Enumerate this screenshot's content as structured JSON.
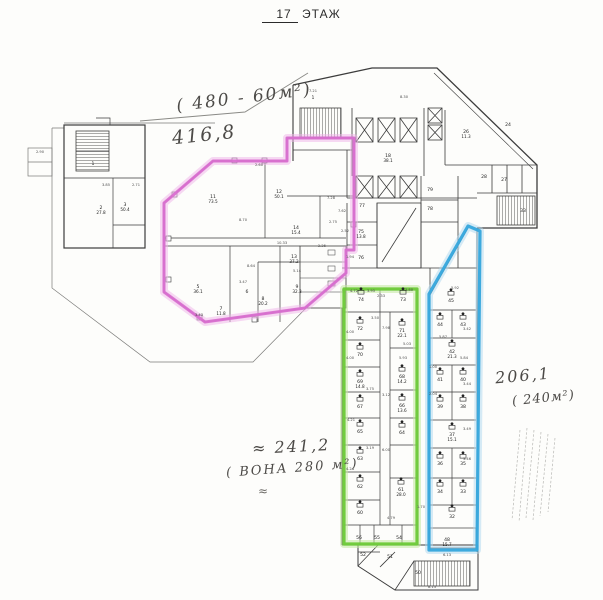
{
  "title": {
    "floor_number": "17",
    "floor_word": "ЭТАЖ"
  },
  "annotations": {
    "top_area_range": "( 480 - 60м²)",
    "top_area_value": "416,8",
    "mid_area_value": "≈ 241,2",
    "mid_area_note": "( ВОНА  280 м²)",
    "mid_squiggle": "≈",
    "right_area_value": "206,1",
    "right_area_note": "( 240м²)"
  },
  "highlights": {
    "pink": {
      "color": "#d96fd0",
      "halo": "#f0b4ea"
    },
    "green": {
      "color": "#6cc938",
      "halo": "#c2e8a0"
    },
    "blue": {
      "color": "#35a6dc",
      "halo": "#aed8f0"
    }
  },
  "rooms": [
    {
      "n": "1",
      "x": 93,
      "y": 165
    },
    {
      "n": "2",
      "a": "27.8",
      "x": 101,
      "y": 209
    },
    {
      "n": "3",
      "a": "50.4",
      "x": 125,
      "y": 206
    },
    {
      "n": "11",
      "a": "73.5",
      "x": 213,
      "y": 198
    },
    {
      "n": "12",
      "a": "50.1",
      "x": 279,
      "y": 193
    },
    {
      "n": "14",
      "a": "15.4",
      "x": 296,
      "y": 229
    },
    {
      "n": "13",
      "a": "37.2",
      "x": 294,
      "y": 258
    },
    {
      "n": "9",
      "a": "32.3",
      "x": 297,
      "y": 288
    },
    {
      "n": "8",
      "a": "20.2",
      "x": 263,
      "y": 300
    },
    {
      "n": "7",
      "a": "11.8",
      "x": 221,
      "y": 310
    },
    {
      "n": "5",
      "a": "36.1",
      "x": 198,
      "y": 288
    },
    {
      "n": "6",
      "x": 247,
      "y": 293
    },
    {
      "n": "1",
      "x": 313,
      "y": 99
    },
    {
      "n": "18",
      "a": "38.1",
      "x": 388,
      "y": 157
    },
    {
      "n": "26",
      "a": "11.3",
      "x": 466,
      "y": 133
    },
    {
      "n": "24",
      "x": 508,
      "y": 126
    },
    {
      "n": "77",
      "x": 362,
      "y": 207
    },
    {
      "n": "75",
      "a": "13.8",
      "x": 361,
      "y": 233
    },
    {
      "n": "76",
      "x": 361,
      "y": 259
    },
    {
      "n": "79",
      "x": 430,
      "y": 191
    },
    {
      "n": "78",
      "x": 430,
      "y": 210
    },
    {
      "n": "28",
      "x": 484,
      "y": 178
    },
    {
      "n": "27",
      "x": 504,
      "y": 181
    },
    {
      "n": "33",
      "x": 523,
      "y": 212
    },
    {
      "n": "74",
      "x": 361,
      "y": 301,
      "wc": 1
    },
    {
      "n": "73",
      "x": 403,
      "y": 301,
      "wc": 1
    },
    {
      "n": "72",
      "x": 360,
      "y": 330,
      "wc": 1
    },
    {
      "n": "71",
      "a": "22.1",
      "x": 402,
      "y": 332,
      "wc": 1
    },
    {
      "n": "70",
      "x": 360,
      "y": 356,
      "wc": 1
    },
    {
      "n": "69",
      "a": "14.8",
      "x": 360,
      "y": 383,
      "wc": 1
    },
    {
      "n": "68",
      "a": "14.2",
      "x": 402,
      "y": 378,
      "wc": 1
    },
    {
      "n": "67",
      "x": 360,
      "y": 408,
      "wc": 1
    },
    {
      "n": "66",
      "a": "13.6",
      "x": 402,
      "y": 407,
      "wc": 1
    },
    {
      "n": "65",
      "x": 360,
      "y": 433,
      "wc": 1
    },
    {
      "n": "64",
      "x": 402,
      "y": 434,
      "wc": 1
    },
    {
      "n": "63",
      "x": 360,
      "y": 460,
      "wc": 1
    },
    {
      "n": "62",
      "x": 360,
      "y": 488,
      "wc": 1
    },
    {
      "n": "61",
      "a": "28.0",
      "x": 401,
      "y": 491,
      "wc": 1
    },
    {
      "n": "60",
      "x": 360,
      "y": 514,
      "wc": 1
    },
    {
      "n": "56",
      "x": 359,
      "y": 539
    },
    {
      "n": "55",
      "x": 377,
      "y": 539
    },
    {
      "n": "54",
      "x": 399,
      "y": 539
    },
    {
      "n": "45",
      "x": 451,
      "y": 302,
      "wc": 1
    },
    {
      "n": "44",
      "x": 440,
      "y": 326,
      "wc": 1
    },
    {
      "n": "43",
      "x": 463,
      "y": 326,
      "wc": 1
    },
    {
      "n": "42",
      "a": "21.3",
      "x": 452,
      "y": 353,
      "wc": 1
    },
    {
      "n": "41",
      "x": 440,
      "y": 381,
      "wc": 1
    },
    {
      "n": "40",
      "x": 463,
      "y": 381,
      "wc": 1
    },
    {
      "n": "39",
      "x": 440,
      "y": 408,
      "wc": 1
    },
    {
      "n": "38",
      "x": 463,
      "y": 408,
      "wc": 1
    },
    {
      "n": "37",
      "a": "15.1",
      "x": 452,
      "y": 436,
      "wc": 1
    },
    {
      "n": "36",
      "x": 440,
      "y": 465,
      "wc": 1
    },
    {
      "n": "35",
      "x": 463,
      "y": 465,
      "wc": 1
    },
    {
      "n": "34",
      "x": 440,
      "y": 493,
      "wc": 1
    },
    {
      "n": "33",
      "x": 463,
      "y": 493,
      "wc": 1
    },
    {
      "n": "32",
      "x": 452,
      "y": 518,
      "wc": 1
    },
    {
      "n": "48",
      "a": "15.7",
      "x": 447,
      "y": 541
    },
    {
      "n": "52",
      "x": 363,
      "y": 556
    },
    {
      "n": "51",
      "x": 390,
      "y": 558
    },
    {
      "n": "50",
      "x": 418,
      "y": 574
    }
  ],
  "dims": [
    {
      "t": "7.21",
      "x": 313,
      "y": 92
    },
    {
      "t": "8.30",
      "x": 404,
      "y": 98
    },
    {
      "t": "2.60",
      "x": 259,
      "y": 166
    },
    {
      "t": "8.70",
      "x": 243,
      "y": 221
    },
    {
      "t": "7.28",
      "x": 331,
      "y": 199
    },
    {
      "t": "7.62",
      "x": 342,
      "y": 212
    },
    {
      "t": "2.75",
      "x": 333,
      "y": 223
    },
    {
      "t": "2.52",
      "x": 345,
      "y": 232
    },
    {
      "t": "10.33",
      "x": 282,
      "y": 244
    },
    {
      "t": "2.25",
      "x": 322,
      "y": 247
    },
    {
      "t": "8.64",
      "x": 251,
      "y": 267
    },
    {
      "t": "3.47",
      "x": 243,
      "y": 283
    },
    {
      "t": "5.14",
      "x": 297,
      "y": 272
    },
    {
      "t": "1.94",
      "x": 350,
      "y": 258
    },
    {
      "t": "3.43",
      "x": 199,
      "y": 316
    },
    {
      "t": "4.72",
      "x": 354,
      "y": 292
    },
    {
      "t": "3.95",
      "x": 371,
      "y": 292
    },
    {
      "t": "3.80",
      "x": 409,
      "y": 291
    },
    {
      "t": "2.33",
      "x": 381,
      "y": 297
    },
    {
      "t": "4.00",
      "x": 350,
      "y": 333
    },
    {
      "t": "3.50",
      "x": 375,
      "y": 319
    },
    {
      "t": "7.98",
      "x": 386,
      "y": 329
    },
    {
      "t": "5.03",
      "x": 407,
      "y": 345
    },
    {
      "t": "4.00",
      "x": 350,
      "y": 359
    },
    {
      "t": "5.93",
      "x": 403,
      "y": 359
    },
    {
      "t": "3.75",
      "x": 370,
      "y": 390
    },
    {
      "t": "3.12",
      "x": 386,
      "y": 396
    },
    {
      "t": "4.21",
      "x": 351,
      "y": 421
    },
    {
      "t": "3.19",
      "x": 370,
      "y": 449
    },
    {
      "t": "6.00",
      "x": 386,
      "y": 451
    },
    {
      "t": "4.24",
      "x": 350,
      "y": 470
    },
    {
      "t": "4.79",
      "x": 391,
      "y": 519
    },
    {
      "t": "1.70",
      "x": 421,
      "y": 508
    },
    {
      "t": "5.92",
      "x": 455,
      "y": 289
    },
    {
      "t": "3.42",
      "x": 467,
      "y": 330
    },
    {
      "t": "5.87",
      "x": 443,
      "y": 338
    },
    {
      "t": "5.84",
      "x": 464,
      "y": 359
    },
    {
      "t": "1.00",
      "x": 433,
      "y": 368
    },
    {
      "t": "3.44",
      "x": 467,
      "y": 385
    },
    {
      "t": "2.04",
      "x": 433,
      "y": 395
    },
    {
      "t": "3.49",
      "x": 467,
      "y": 430
    },
    {
      "t": "3.46",
      "x": 467,
      "y": 460
    },
    {
      "t": "6.13",
      "x": 447,
      "y": 556
    },
    {
      "t": "8.13",
      "x": 432,
      "y": 588
    },
    {
      "t": "2.90",
      "x": 40,
      "y": 153
    },
    {
      "t": "3.85",
      "x": 106,
      "y": 186
    },
    {
      "t": "2.71",
      "x": 136,
      "y": 186
    }
  ]
}
